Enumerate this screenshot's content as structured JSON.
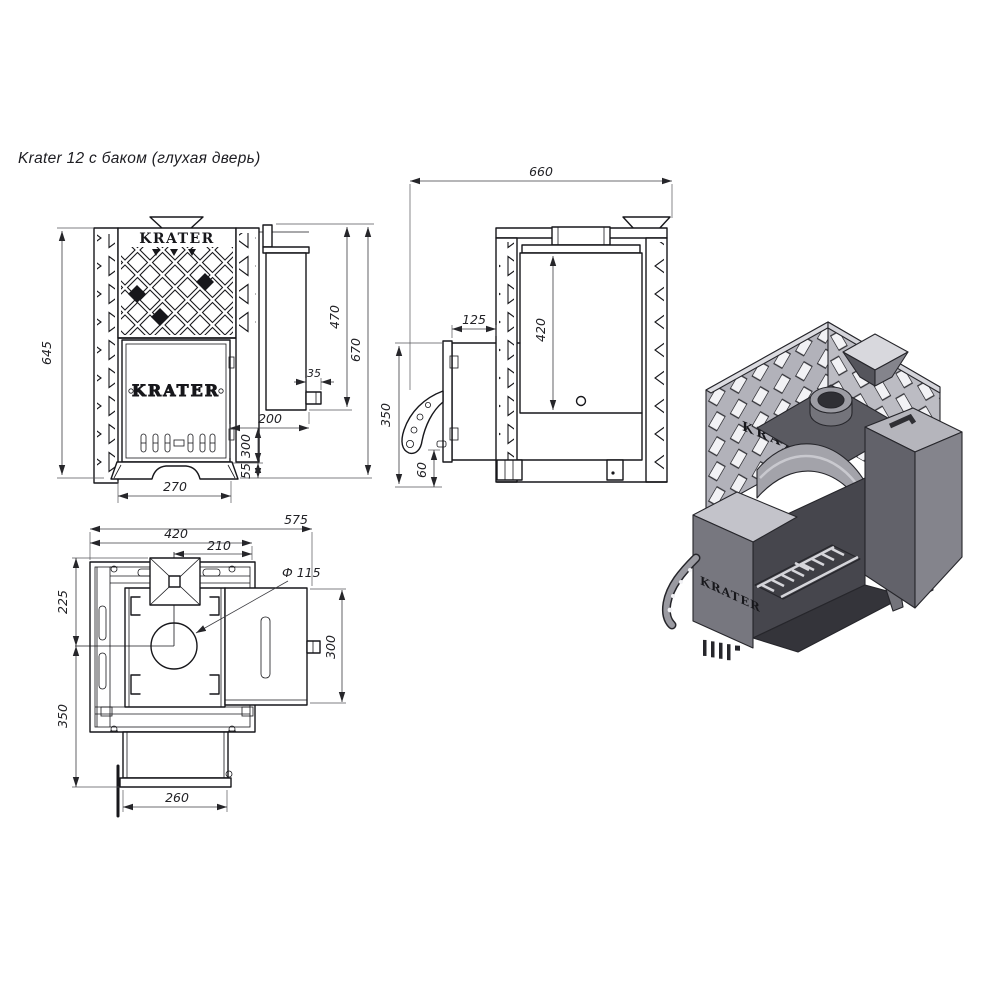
{
  "title": "Krater 12 с баком (глухая дверь)",
  "brand": "KRATER",
  "colors": {
    "line": "#17171b",
    "dimension": "#3b3b40",
    "paper": "#ffffff",
    "iso_light": "#c9c9cf",
    "iso_mid": "#9a9aa1",
    "iso_dark": "#55555c"
  },
  "front": {
    "cage_height": "645",
    "tank_height": "470",
    "overall_height": "670",
    "outlet_width": "35",
    "tank_span": "200",
    "lower_zone": "300",
    "base_height": "55",
    "base_width": "270",
    "brand_grill": "KRATER",
    "brand_door": "KRATER"
  },
  "side": {
    "overall_depth": "660",
    "door_offset": "125",
    "tank_width": "420",
    "front_height": "350",
    "bottom_clearance": "60"
  },
  "top": {
    "overall_width": "575",
    "cage_width": "420",
    "chimney_offset": "210",
    "front_section": "225",
    "rear_section": "350",
    "chimney_diameter": "Ф 115",
    "tank_depth": "300",
    "door_width": "260"
  },
  "iso": {
    "brand_wall": "KRATER",
    "brand_door": "KRATER"
  }
}
